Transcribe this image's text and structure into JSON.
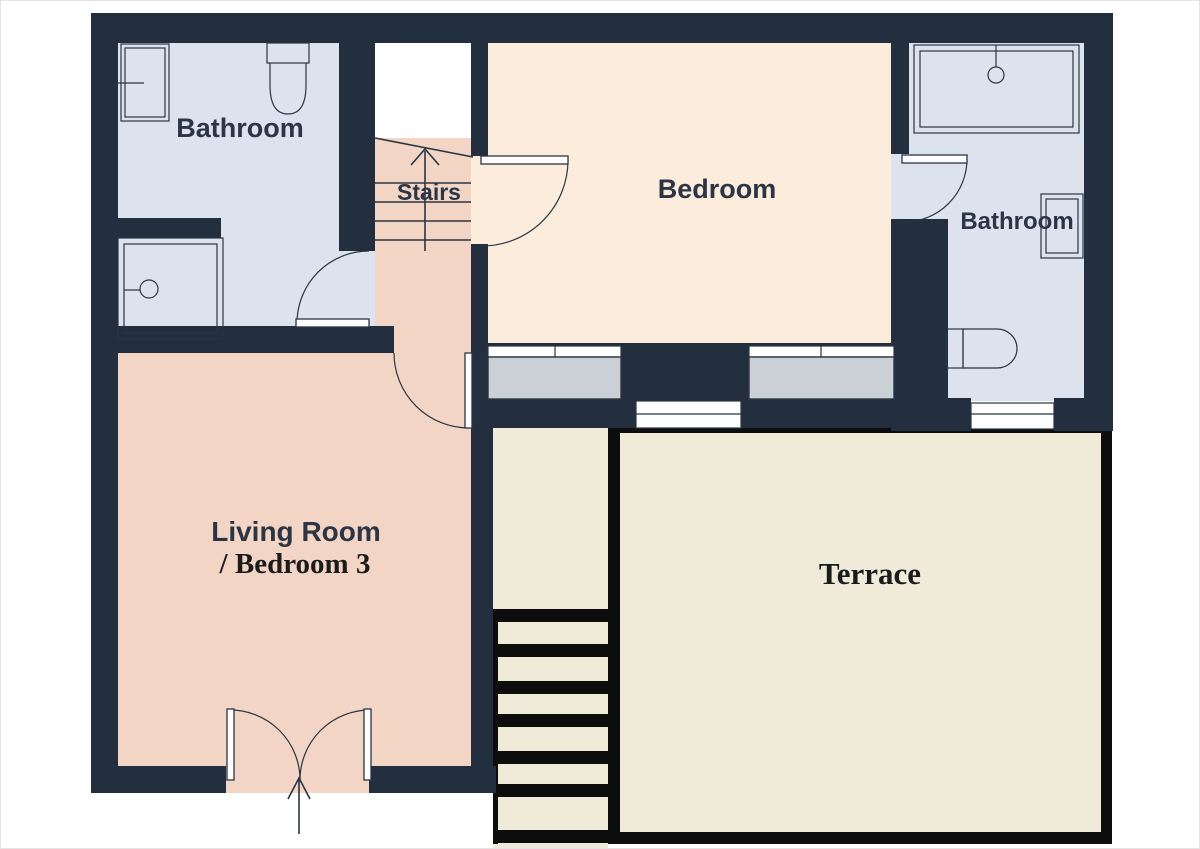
{
  "title": "Floor plan",
  "palette": {
    "wall_navy": "#232f3e",
    "bathroom_floor_blue": "#dde3ee",
    "bedroom_floor_peach": "#fcecdb",
    "living_room_floor_pink": "#f2d5c5",
    "terrace_floor_cream": "#f0ebd9",
    "window_gray": "#cbcfd6",
    "terrace_outline_black": "#0d0d0d",
    "fixture_line": "#2a3542",
    "sans_label_color": "#2b3545",
    "serif_label_color": "#1b1b1b",
    "background": "#ffffff"
  },
  "rooms": {
    "bathroom_top_left": {
      "label": "Bathroom"
    },
    "stairs": {
      "label": "Stairs"
    },
    "bedroom": {
      "label": "Bedroom"
    },
    "bathroom_top_right": {
      "label": "Bathroom"
    },
    "living_room": {
      "label_line1": "Living Room",
      "label_line2": "/ Bedroom 3"
    },
    "terrace": {
      "label": "Terrace"
    }
  }
}
